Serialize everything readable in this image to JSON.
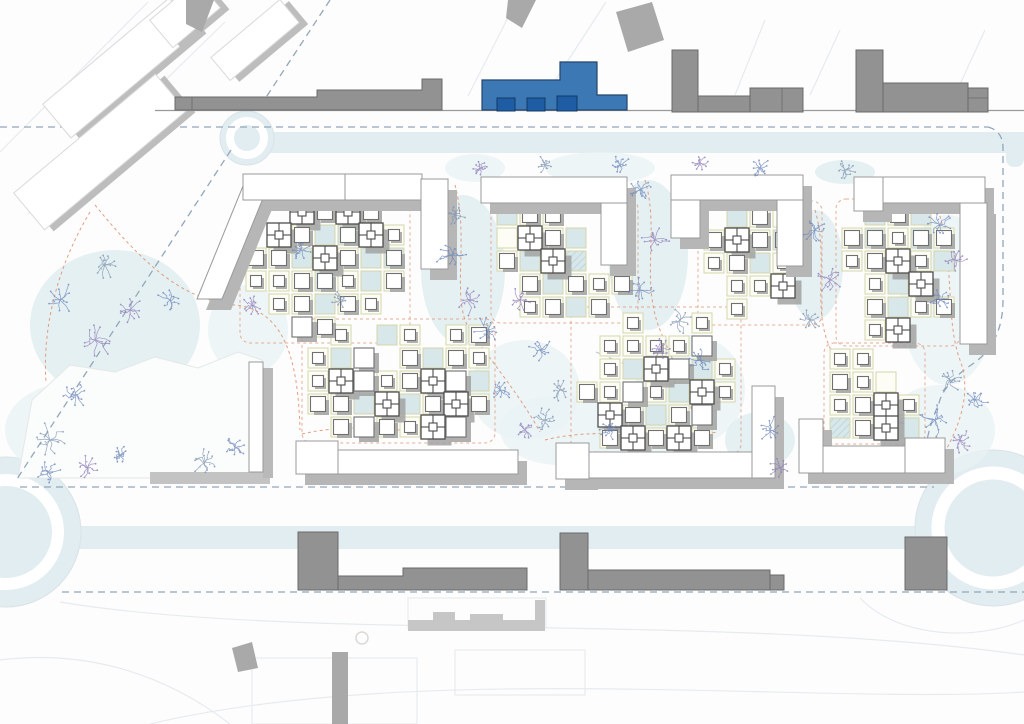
{
  "meta": {
    "title": "architectural-masterplan-site-plan",
    "canvas": {
      "w": 1024,
      "h": 724
    },
    "cell_legend": ". empty | w white-cell | b blue-cell | h hatched-cell | s/m/l/p small/medium/large/courtyard building on white cell | S/M/L/P same on blue cell"
  },
  "palette": {
    "background": "#fdfdfd",
    "road_band": "#e2edf1",
    "blob": "#e8f1f4",
    "blob_dark": "#dcebee",
    "boundary_dash": "#92a7ba",
    "path_orange": "#e09272",
    "cell_stroke": "#d4d6aa",
    "cell_white": "#fdfdf6",
    "cell_blue": "#d8e7ea",
    "hatch_line": "#b9d4d9",
    "bldg_fill": "#ffffff",
    "bldg_stroke": "#707070",
    "plus_stroke": "#4d4d4d",
    "shadow_small": "#a2a2a2",
    "shadow_frame": "#b6b6b6",
    "context_gray": "#929292",
    "context_gray_stroke": "#6a6a6a",
    "context_light": "#c6c6c6",
    "diag_white": "#ffffff",
    "diag_stroke": "#d9d9d9",
    "highlight_blue": "#3c78b4",
    "highlight_blue_stroke": "#24456d",
    "highlight_blue_dark": "#1e5ca3",
    "highlight_blue_dark_stroke": "#123a66",
    "street_line": "#9a9a9a",
    "faint_line": "#e7ebed",
    "plaza_fill": "#fbfcfc",
    "plaza_stroke": "#e4e8e8",
    "tree_colors": [
      "#6d86bb",
      "#8d7cb8",
      "#7e93b0"
    ]
  },
  "roads": {
    "top_street_line": {
      "x1": 155,
      "y1": 110.5,
      "x2": 1024,
      "y2": 110.5
    },
    "top_band": {
      "x": 256,
      "y": 132,
      "w": 768,
      "h": 21
    },
    "bottom_band": {
      "x": 70,
      "y": 526,
      "w": 954,
      "h": 23
    },
    "corner_band_tr": {
      "x": 1006,
      "y": 133,
      "w": 18,
      "h": 34
    },
    "roundabout_left": {
      "cx": 6,
      "cy": 532,
      "r": 75,
      "ring_r": 52,
      "ring_w": 12
    },
    "roundabout_right": {
      "cx": 993,
      "cy": 528,
      "r": 78,
      "ring_r": 55,
      "ring_w": 13
    },
    "roundabout_top": {
      "cx": 247,
      "cy": 138,
      "r": 27,
      "ring_r": 17,
      "ring_w": 8
    }
  },
  "boundaries": {
    "dash": "7 5",
    "paths": [
      "M 0,127 L 988,127",
      "M 988,127 Q 1003,131 1003,148 L 1003,300 Q 1003,342 974,363 Q 944,383 939,403 Q 918,452 929,479",
      "M 231,150 L 15,482",
      "M 330,0 L 259,108",
      "M 20,487 L 934,487",
      "M 62,592 L 1024,592"
    ],
    "micro_dashes": [
      "M 596,352 l 38,16",
      "M 640,455 l 30,10"
    ]
  },
  "faint_lines": {
    "paths": [
      "M 0,152 L 148,2",
      "M 28,214 L 225,22",
      "M 468,96 L 516,2",
      "M 545,96 L 606,2",
      "M 735,95 L 765,20",
      "M 810,95 L 840,30",
      "M 955,95 L 985,30",
      "M 60,602 C 300,642 720,612 1024,655",
      "M 150,724 C 420,660 820,705 1024,692",
      "M 0,660 C 80,650 160,670 230,724",
      "M 860,598 C 900,640 980,640 1024,620"
    ],
    "rects": [
      {
        "x": 252,
        "y": 658,
        "w": 165,
        "h": 66
      },
      {
        "x": 455,
        "y": 650,
        "w": 130,
        "h": 45
      },
      {
        "x": 408,
        "y": 598,
        "w": 138,
        "h": 30
      }
    ]
  },
  "landscape_blobs": [
    {
      "cx": 115,
      "cy": 325,
      "rx": 85,
      "ry": 75
    },
    {
      "cx": 75,
      "cy": 430,
      "rx": 70,
      "ry": 48
    },
    {
      "cx": 248,
      "cy": 330,
      "rx": 40,
      "ry": 45
    },
    {
      "cx": 463,
      "cy": 270,
      "rx": 42,
      "ry": 75
    },
    {
      "cx": 525,
      "cy": 390,
      "rx": 55,
      "ry": 50
    },
    {
      "cx": 560,
      "cy": 430,
      "rx": 60,
      "ry": 35
    },
    {
      "cx": 648,
      "cy": 255,
      "rx": 40,
      "ry": 75
    },
    {
      "cx": 690,
      "cy": 390,
      "rx": 55,
      "ry": 55
    },
    {
      "cx": 640,
      "cy": 440,
      "rx": 50,
      "ry": 30
    },
    {
      "cx": 815,
      "cy": 265,
      "rx": 28,
      "ry": 55
    },
    {
      "cx": 948,
      "cy": 300,
      "rx": 48,
      "ry": 85
    },
    {
      "cx": 940,
      "cy": 430,
      "rx": 55,
      "ry": 45
    },
    {
      "cx": 760,
      "cy": 440,
      "rx": 35,
      "ry": 28
    },
    {
      "cx": 600,
      "cy": 168,
      "rx": 55,
      "ry": 16
    },
    {
      "cx": 475,
      "cy": 168,
      "rx": 30,
      "ry": 14
    },
    {
      "cx": 845,
      "cy": 172,
      "rx": 30,
      "ry": 12
    }
  ],
  "plaza": {
    "outline": [
      [
        18,
        478
      ],
      [
        32,
        400
      ],
      [
        70,
        365
      ],
      [
        115,
        372
      ],
      [
        155,
        357
      ],
      [
        198,
        368
      ],
      [
        238,
        352
      ],
      [
        262,
        360
      ],
      [
        262,
        472
      ],
      [
        238,
        478
      ]
    ],
    "thin_slab": {
      "x": 249,
      "y": 362,
      "w": 14,
      "h": 110
    },
    "shadow_strip": {
      "x": 263,
      "y": 368,
      "w": 10,
      "h": 110
    },
    "shadow_band": {
      "x": 150,
      "y": 472,
      "w": 120,
      "h": 12
    }
  },
  "clusters": [
    {
      "name": "cluster-a",
      "x": 246,
      "y": 202,
      "cell": 23,
      "rows": [
        "..pmPm.",
        ".pmbMPs",
        "mmbPmbM",
        "ssmMsbm",
        ".smbms.",
        "..lm..."
      ]
    },
    {
      "name": "cluster-b",
      "x": 497,
      "y": 205,
      "cell": 23,
      "rows": [
        "bmm...",
        "wpmb..",
        "mbPh..",
        ".mbmsm",
        ".smbm."
      ]
    },
    {
      "name": "cluster-c",
      "x": 704,
      "y": 207,
      "cell": 23,
      "rows": [
        ".bmw.",
        "mpmM.",
        "smbs.",
        ".ssP.",
        ".s..."
      ]
    },
    {
      "name": "cluster-d",
      "x": 842,
      "y": 205,
      "cell": 23,
      "rows": [
        ".bmb.",
        "mMsMm",
        "smPsb",
        ".sbP.",
        ".mbsm",
        ".sP.."
      ]
    },
    {
      "name": "cluster-e",
      "x": 308,
      "y": 325,
      "cell": 23,
      "rows": [
        ".s.bs.sm",
        "sbl.mbms",
        "sPlsmPlb",
        "mmbPbmPm",
        ".mlmsPl."
      ]
    },
    {
      "name": "cluster-f",
      "x": 577,
      "y": 313,
      "cell": 23,
      "rows": [
        "..s..s.",
        ".ssssl.",
        ".sbPlbs",
        "mslsbPs",
        ".Pmbml.",
        ".mPmPm."
      ]
    },
    {
      "name": "cluster-g",
      "x": 830,
      "y": 349,
      "cell": 23,
      "rows": [
        "ss..",
        "msw.",
        "smPs",
        "hmPb"
      ]
    }
  ],
  "frames": {
    "polys": [
      {
        "name": "frame-a-arm",
        "pts": [
          [
            197,
            299
          ],
          [
            243,
            186
          ],
          [
            268,
            186
          ],
          [
            222,
            299
          ]
        ]
      }
    ],
    "rects": [
      {
        "name": "frame-a-top",
        "x": 243,
        "y": 174,
        "w": 102,
        "h": 26
      },
      {
        "name": "frame-a-top2",
        "x": 345,
        "y": 174,
        "w": 77,
        "h": 26
      },
      {
        "name": "frame-a-vert",
        "x": 421,
        "y": 179,
        "w": 27,
        "h": 90
      },
      {
        "name": "frame-b-top",
        "x": 481,
        "y": 177,
        "w": 146,
        "h": 26
      },
      {
        "name": "frame-b-vert",
        "x": 601,
        "y": 203,
        "w": 26,
        "h": 62
      },
      {
        "name": "frame-c-top",
        "x": 671,
        "y": 175,
        "w": 132,
        "h": 25
      },
      {
        "name": "frame-c-stub",
        "x": 671,
        "y": 200,
        "w": 29,
        "h": 38
      },
      {
        "name": "frame-c-vert",
        "x": 777,
        "y": 200,
        "w": 26,
        "h": 66
      },
      {
        "name": "frame-d-left",
        "x": 854,
        "y": 177,
        "w": 29,
        "h": 34
      },
      {
        "name": "frame-d-top",
        "x": 883,
        "y": 177,
        "w": 102,
        "h": 26
      },
      {
        "name": "frame-d-vert",
        "x": 960,
        "y": 203,
        "w": 27,
        "h": 141
      },
      {
        "name": "slab-e-block",
        "x": 296,
        "y": 441,
        "w": 42,
        "h": 33
      },
      {
        "name": "slab-e-bar",
        "x": 338,
        "y": 450,
        "w": 180,
        "h": 24
      },
      {
        "name": "slab-f-block",
        "x": 556,
        "y": 443,
        "w": 33,
        "h": 36
      },
      {
        "name": "slab-f-bar",
        "x": 589,
        "y": 452,
        "w": 164,
        "h": 26
      },
      {
        "name": "slab-f-vert",
        "x": 752,
        "y": 386,
        "w": 23,
        "h": 92
      },
      {
        "name": "slab-g-block",
        "x": 799,
        "y": 419,
        "w": 24,
        "h": 54
      },
      {
        "name": "slab-g-bar",
        "x": 823,
        "y": 446,
        "w": 122,
        "h": 27
      },
      {
        "name": "slab-g-block2",
        "x": 905,
        "y": 438,
        "w": 40,
        "h": 35
      }
    ]
  },
  "context": {
    "top_left_diagonal": [
      {
        "cx": 120,
        "cy": 68,
        "w": 165,
        "h": 44,
        "a": -40
      },
      {
        "cx": 100,
        "cy": 152,
        "w": 185,
        "h": 48,
        "a": -40
      },
      {
        "cx": 255,
        "cy": 40,
        "w": 90,
        "h": 30,
        "a": -40
      },
      {
        "cx": 185,
        "cy": 14,
        "w": 62,
        "h": 36,
        "a": -40
      }
    ],
    "gray_wedges": [
      [
        [
          186,
          0
        ],
        [
          214,
          0
        ],
        [
          202,
          32
        ],
        [
          186,
          24
        ]
      ],
      [
        [
          508,
          0
        ],
        [
          536,
          0
        ],
        [
          522,
          28
        ],
        [
          506,
          18
        ]
      ],
      [
        [
          616,
          12
        ],
        [
          652,
          2
        ],
        [
          664,
          40
        ],
        [
          628,
          52
        ]
      ],
      [
        [
          232,
          648
        ],
        [
          252,
          642
        ],
        [
          258,
          668
        ],
        [
          238,
          672
        ]
      ]
    ],
    "top_street_slab": "M175,110 L175,97 L317,97 L317,90 L422,90 L422,79 L442,79 L442,110 Z",
    "top_street_slab_line_x": 192,
    "top_right_groups": [
      {
        "rects": [
          [
            672,
            50,
            26,
            62
          ],
          [
            698,
            96,
            84,
            16
          ],
          [
            750,
            88,
            53,
            24
          ]
        ],
        "lines": [
          [
            782,
            88,
            782,
            112
          ]
        ]
      },
      {
        "rects": [
          [
            856,
            50,
            27,
            62
          ],
          [
            883,
            83,
            85,
            29
          ],
          [
            968,
            88,
            20,
            24
          ]
        ],
        "lines": [
          [
            968,
            98,
            988,
            98
          ]
        ]
      }
    ],
    "blue_building": {
      "poly": "M482,110 L482,80 L560,80 L560,62 L597,62 L597,95 L627,95 L627,110 Z",
      "insets": [
        [
          497,
          98,
          18,
          13
        ],
        [
          527,
          98,
          18,
          13
        ],
        [
          557,
          96,
          20,
          15
        ]
      ],
      "divider_x": 560
    },
    "bottom_gray": {
      "tower1": [
        298,
        532,
        40,
        58
      ],
      "wing1": "M338,590 L338,576 L403,576 L403,568 L527,568 L527,590 Z",
      "tower2": [
        560,
        533,
        28,
        57
      ],
      "wing2": [
        588,
        570,
        182,
        20
      ],
      "annex2": [
        770,
        575,
        14,
        15
      ],
      "block3": [
        905,
        537,
        42,
        53
      ],
      "bar_left": [
        332,
        652,
        16,
        72
      ],
      "manhole": {
        "cx": 362,
        "cy": 638,
        "r": 6
      }
    },
    "silhouette": {
      "base": [
        408,
        620,
        137,
        11
      ],
      "bumps": [
        [
          433,
          612,
          22,
          8
        ],
        [
          470,
          614,
          33,
          6
        ],
        [
          535,
          600,
          10,
          20
        ]
      ]
    }
  },
  "orange_paths": [
    "M 95,205 C 140,260 180,300 235,305 C 285,310 298,360 300,430",
    "M 455,185 C 470,240 450,300 470,330 C 490,360 520,395 540,432",
    "M 645,180 C 660,230 640,280 660,330 C 680,380 700,405 690,442",
    "M 815,210 C 830,260 810,310 832,352",
    "M 938,210 C 955,260 945,320 960,360 C 975,400 952,442 933,472",
    "M 90,212 C 60,262 42,322 46,382",
    "M 302,434 C 360,420 420,436 468,432",
    "M 545,440 C 600,426 660,440 718,432"
  ],
  "trees": [
    [
      60,
      300,
      14,
      0
    ],
    [
      95,
      340,
      16,
      1
    ],
    [
      75,
      395,
      13,
      0
    ],
    [
      50,
      440,
      15,
      2
    ],
    [
      130,
      310,
      12,
      1
    ],
    [
      170,
      300,
      10,
      0
    ],
    [
      105,
      265,
      12,
      2
    ],
    [
      48,
      472,
      11,
      0
    ],
    [
      88,
      468,
      12,
      1
    ],
    [
      120,
      455,
      9,
      0
    ],
    [
      205,
      462,
      12,
      2
    ],
    [
      235,
      448,
      10,
      0
    ],
    [
      452,
      255,
      14,
      0
    ],
    [
      470,
      300,
      13,
      1
    ],
    [
      455,
      215,
      10,
      2
    ],
    [
      488,
      330,
      12,
      0
    ],
    [
      520,
      300,
      11,
      1
    ],
    [
      540,
      350,
      12,
      0
    ],
    [
      560,
      390,
      10,
      2
    ],
    [
      500,
      390,
      11,
      0
    ],
    [
      525,
      430,
      10,
      1
    ],
    [
      640,
      190,
      12,
      0
    ],
    [
      655,
      240,
      13,
      1
    ],
    [
      640,
      290,
      12,
      0
    ],
    [
      680,
      320,
      11,
      2
    ],
    [
      700,
      360,
      12,
      0
    ],
    [
      660,
      350,
      10,
      1
    ],
    [
      815,
      230,
      12,
      0
    ],
    [
      830,
      280,
      12,
      1
    ],
    [
      810,
      320,
      10,
      2
    ],
    [
      940,
      225,
      12,
      0
    ],
    [
      955,
      260,
      12,
      1
    ],
    [
      940,
      300,
      10,
      0
    ],
    [
      950,
      380,
      13,
      2
    ],
    [
      935,
      420,
      14,
      0
    ],
    [
      960,
      440,
      12,
      1
    ],
    [
      975,
      400,
      11,
      0
    ],
    [
      545,
      165,
      8,
      2
    ],
    [
      620,
      165,
      9,
      0
    ],
    [
      700,
      163,
      8,
      1
    ],
    [
      760,
      168,
      9,
      0
    ],
    [
      845,
      170,
      9,
      2
    ],
    [
      480,
      168,
      8,
      1
    ],
    [
      770,
      430,
      12,
      0
    ],
    [
      780,
      468,
      10,
      1
    ],
    [
      545,
      420,
      12,
      2
    ],
    [
      300,
      250,
      9,
      0
    ],
    [
      252,
      305,
      10,
      1
    ],
    [
      340,
      300,
      8,
      2
    ],
    [
      610,
      430,
      9,
      0
    ]
  ]
}
